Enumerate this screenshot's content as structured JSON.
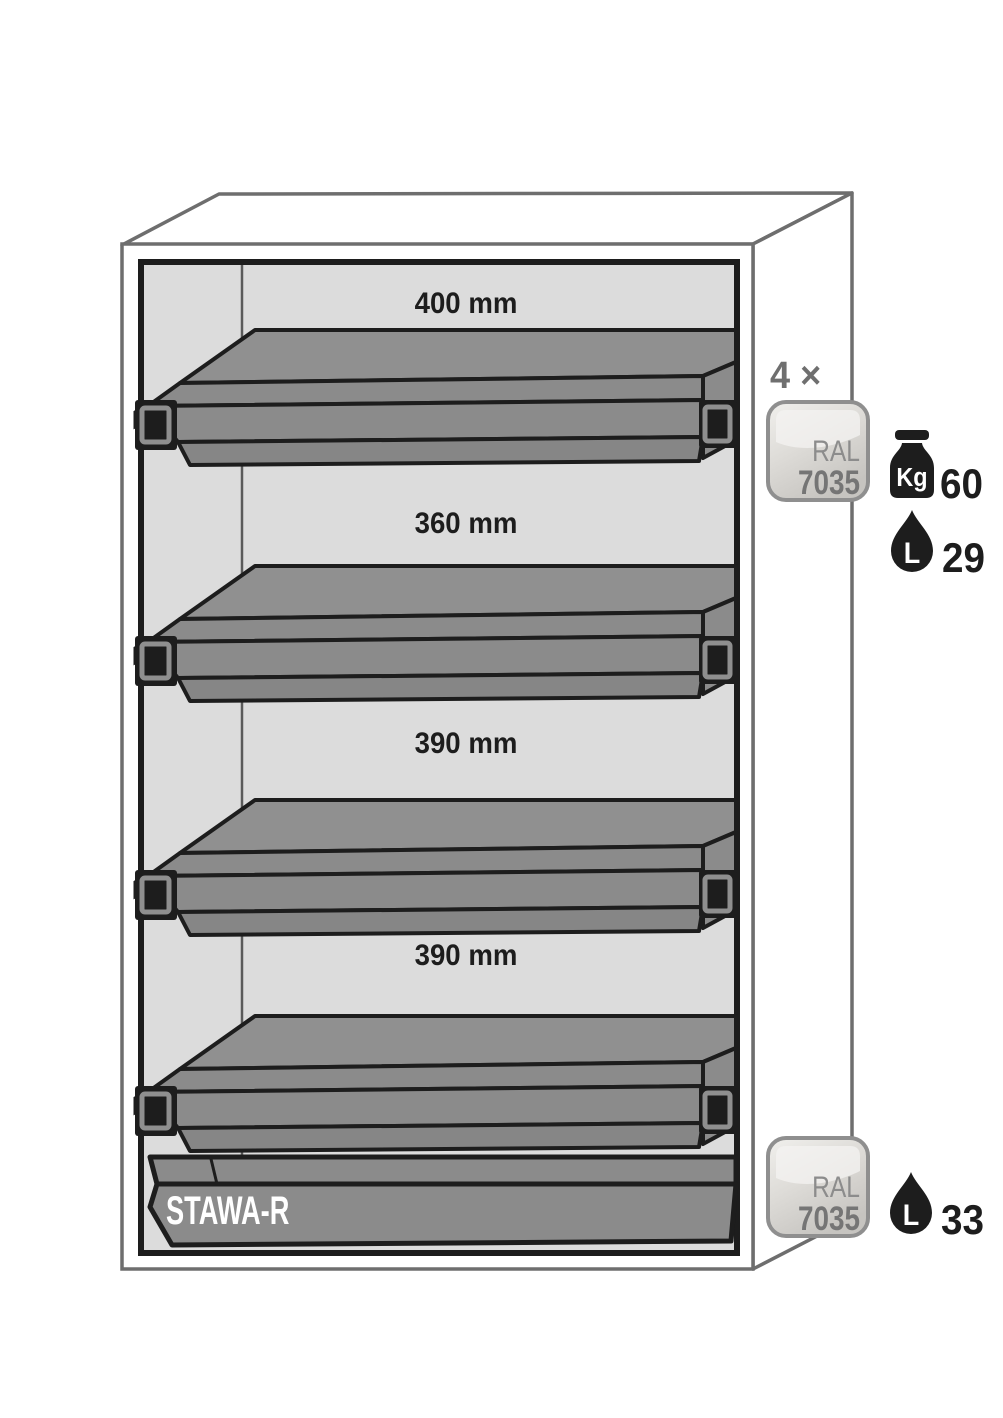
{
  "cabinet": {
    "shelves": [
      {
        "spacing_label": "400 mm"
      },
      {
        "spacing_label": "360 mm"
      },
      {
        "spacing_label": "390 mm"
      },
      {
        "spacing_label": "390 mm"
      }
    ],
    "sump_label": "STAWA-R"
  },
  "annotations": {
    "tray_count": "4 ×",
    "shelf_color_badge": {
      "line1": "RAL",
      "line2": "7035"
    },
    "shelf_load": {
      "icon": "kg-weight-icon",
      "unit": "Kg",
      "value": "60"
    },
    "shelf_volume": {
      "icon": "litre-drop-icon",
      "unit": "L",
      "value": "29"
    },
    "sump_color_badge": {
      "line1": "RAL",
      "line2": "7035"
    },
    "sump_volume": {
      "icon": "litre-drop-icon",
      "unit": "L",
      "value": "33"
    }
  },
  "colors": {
    "tray_gray": "#8b8b8b",
    "interior_gray": "#dcdcdc",
    "outline_black": "#1d1d1d",
    "cabinet_outline_gray": "#6e6e6e",
    "annotation_gray": "#6f6f6f",
    "badge_ral7035_fill": "#d8d6d3"
  }
}
